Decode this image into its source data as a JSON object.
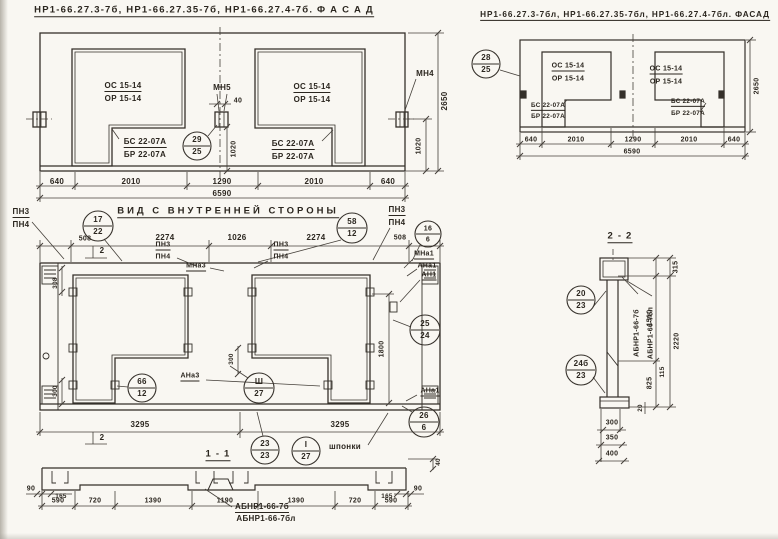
{
  "colors": {
    "paper": "#f9f7f2",
    "ink": "#2b261f"
  },
  "regions": {
    "facade-left": {
      "title": "НР1-66.27.3-7б, НР1-66.27.35-7б, НР1-66.27.4-7б.  Ф А С А Д",
      "labels": [
        {
          "t": "ОС 15-14",
          "x": 123,
          "y": 87,
          "c": "u",
          "n": "window-mark"
        },
        {
          "t": "ОР 15-14",
          "x": 123,
          "y": 99,
          "n": "window-mark"
        },
        {
          "t": "БС 22-07А",
          "x": 145,
          "y": 143,
          "c": "u",
          "n": "block-mark"
        },
        {
          "t": "БР 22-07А",
          "x": 145,
          "y": 155,
          "n": "block-mark"
        },
        {
          "t": "ОС 15-14",
          "x": 312,
          "y": 88,
          "c": "u",
          "n": "window-mark"
        },
        {
          "t": "ОР 15-14",
          "x": 312,
          "y": 100,
          "n": "window-mark"
        },
        {
          "t": "БС 22-07А",
          "x": 293,
          "y": 145,
          "c": "u",
          "n": "block-mark"
        },
        {
          "t": "БР 22-07А",
          "x": 293,
          "y": 157,
          "n": "block-mark"
        },
        {
          "t": "МН5",
          "x": 222,
          "y": 88,
          "n": "anchor-mark"
        },
        {
          "t": "МН4",
          "x": 425,
          "y": 74,
          "n": "anchor-mark"
        },
        {
          "t": "40",
          "x": 238,
          "y": 101,
          "c": "s7",
          "n": "dim"
        },
        {
          "t": "29",
          "x": 197,
          "y": 140,
          "n": "node-number"
        },
        {
          "t": "25",
          "x": 197,
          "y": 152,
          "n": "sheet-number"
        },
        {
          "t": "1020",
          "x": 234,
          "y": 149,
          "c": "r s7",
          "n": "dim"
        },
        {
          "t": "1020",
          "x": 419,
          "y": 146,
          "c": "r s7",
          "n": "dim"
        },
        {
          "t": "2650",
          "x": 445,
          "y": 101,
          "c": "r",
          "n": "dim"
        },
        {
          "t": "640",
          "x": 57,
          "y": 182,
          "n": "dim"
        },
        {
          "t": "2010",
          "x": 131,
          "y": 182,
          "n": "dim"
        },
        {
          "t": "1290",
          "x": 222,
          "y": 182,
          "n": "dim"
        },
        {
          "t": "2010",
          "x": 314,
          "y": 182,
          "n": "dim"
        },
        {
          "t": "640",
          "x": 388,
          "y": 182,
          "n": "dim"
        },
        {
          "t": "6590",
          "x": 222,
          "y": 194,
          "n": "dim-total"
        }
      ]
    },
    "facade-right": {
      "title": "НР1-66.27.3-7бл, НР1-66.27.35-7бл, НР1-66.27.4-7бл. ФАСАД",
      "labels": [
        {
          "t": "28",
          "x": 486,
          "y": 58,
          "n": "node-number"
        },
        {
          "t": "25",
          "x": 486,
          "y": 70,
          "n": "sheet-number"
        },
        {
          "t": "ОС 15-14",
          "x": 568,
          "y": 67,
          "c": "u s7",
          "n": "window-mark"
        },
        {
          "t": "ОР 15-14",
          "x": 568,
          "y": 79,
          "c": "s7",
          "n": "window-mark"
        },
        {
          "t": "БС 22-07А",
          "x": 548,
          "y": 107,
          "c": "u s6",
          "n": "block-mark"
        },
        {
          "t": "БР 22-07А",
          "x": 548,
          "y": 117,
          "c": "s6",
          "n": "block-mark"
        },
        {
          "t": "ОС 15-14",
          "x": 666,
          "y": 70,
          "c": "u s7",
          "n": "window-mark"
        },
        {
          "t": "ОР 15-14",
          "x": 666,
          "y": 82,
          "c": "s7",
          "n": "window-mark"
        },
        {
          "t": "БС 22-07А",
          "x": 688,
          "y": 103,
          "c": "u s6",
          "n": "block-mark"
        },
        {
          "t": "БР 22-07А",
          "x": 688,
          "y": 114,
          "c": "s6",
          "n": "block-mark"
        },
        {
          "t": "640",
          "x": 531,
          "y": 140,
          "c": "s7",
          "n": "dim"
        },
        {
          "t": "2010",
          "x": 576,
          "y": 140,
          "c": "s7",
          "n": "dim"
        },
        {
          "t": "1290",
          "x": 633,
          "y": 140,
          "c": "s7",
          "n": "dim"
        },
        {
          "t": "2010",
          "x": 689,
          "y": 140,
          "c": "s7",
          "n": "dim"
        },
        {
          "t": "640",
          "x": 734,
          "y": 140,
          "c": "s7",
          "n": "dim"
        },
        {
          "t": "6590",
          "x": 632,
          "y": 152,
          "c": "s7",
          "n": "dim-total"
        },
        {
          "t": "2650",
          "x": 757,
          "y": 86,
          "c": "r s7",
          "n": "dim"
        }
      ]
    },
    "inner-view": {
      "title": "ВИД С ВНУТРЕННЕЙ СТОРОНЫ",
      "labels": [
        {
          "t": "ПН3",
          "x": 21,
          "y": 213,
          "c": "u",
          "n": "loop-mark"
        },
        {
          "t": "ПН4",
          "x": 21,
          "y": 225,
          "n": "loop-mark"
        },
        {
          "t": "17",
          "x": 98,
          "y": 220,
          "n": "node-number"
        },
        {
          "t": "22",
          "x": 98,
          "y": 232,
          "n": "sheet-number"
        },
        {
          "t": "58",
          "x": 352,
          "y": 222,
          "n": "node-number"
        },
        {
          "t": "12",
          "x": 352,
          "y": 234,
          "n": "sheet-number"
        },
        {
          "t": "ПН3",
          "x": 397,
          "y": 211,
          "c": "u",
          "n": "loop-mark"
        },
        {
          "t": "ПН4",
          "x": 397,
          "y": 223,
          "n": "loop-mark"
        },
        {
          "t": "16",
          "x": 428,
          "y": 229,
          "c": "s7",
          "n": "node-number"
        },
        {
          "t": "6",
          "x": 428,
          "y": 240,
          "c": "s7",
          "n": "sheet-number"
        },
        {
          "t": "508",
          "x": 85,
          "y": 239,
          "c": "s7",
          "n": "dim"
        },
        {
          "t": "2274",
          "x": 165,
          "y": 238,
          "n": "dim"
        },
        {
          "t": "1026",
          "x": 237,
          "y": 238,
          "n": "dim"
        },
        {
          "t": "2274",
          "x": 316,
          "y": 238,
          "n": "dim"
        },
        {
          "t": "508",
          "x": 400,
          "y": 238,
          "c": "s7",
          "n": "dim"
        },
        {
          "t": "2",
          "x": 102,
          "y": 251,
          "n": "section-mark"
        },
        {
          "t": "2",
          "x": 102,
          "y": 438,
          "n": "section-mark"
        },
        {
          "t": "ПН3",
          "x": 163,
          "y": 246,
          "c": "u s7",
          "n": "loop-mark"
        },
        {
          "t": "ПН4",
          "x": 163,
          "y": 257,
          "c": "s7",
          "n": "loop-mark"
        },
        {
          "t": "ПН3",
          "x": 281,
          "y": 246,
          "c": "u s7",
          "n": "loop-mark"
        },
        {
          "t": "ПН4",
          "x": 281,
          "y": 257,
          "c": "s7",
          "n": "loop-mark"
        },
        {
          "t": "МНа3",
          "x": 196,
          "y": 267,
          "c": "u s7",
          "n": "anchor-mark"
        },
        {
          "t": "308",
          "x": 56,
          "y": 283,
          "c": "r s6",
          "n": "dim"
        },
        {
          "t": "300",
          "x": 56,
          "y": 391,
          "c": "r s6",
          "n": "dim"
        },
        {
          "t": "300",
          "x": 232,
          "y": 359,
          "c": "r s6",
          "n": "dim"
        },
        {
          "t": "66",
          "x": 142,
          "y": 382,
          "n": "node-number"
        },
        {
          "t": "12",
          "x": 142,
          "y": 394,
          "n": "sheet-number"
        },
        {
          "t": "АНа3",
          "x": 190,
          "y": 377,
          "c": "u s7",
          "n": "anchor-mark"
        },
        {
          "t": "Ш",
          "x": 259,
          "y": 382,
          "n": "node-number"
        },
        {
          "t": "27",
          "x": 259,
          "y": 394,
          "n": "sheet-number"
        },
        {
          "t": "МНа1",
          "x": 424,
          "y": 255,
          "c": "u s7",
          "n": "anchor-mark"
        },
        {
          "t": "АНа1",
          "x": 427,
          "y": 266,
          "c": "s7",
          "n": "anchor-mark"
        },
        {
          "t": "АН1",
          "x": 429,
          "y": 276,
          "c": "u s7",
          "n": "anchor-mark"
        },
        {
          "t": "25",
          "x": 425,
          "y": 324,
          "n": "node-number"
        },
        {
          "t": "24",
          "x": 425,
          "y": 336,
          "n": "sheet-number"
        },
        {
          "t": "1800",
          "x": 382,
          "y": 349,
          "c": "r s7",
          "n": "dim"
        },
        {
          "t": "АНа1",
          "x": 430,
          "y": 392,
          "c": "u s7",
          "n": "anchor-mark"
        },
        {
          "t": "26",
          "x": 424,
          "y": 416,
          "n": "node-number"
        },
        {
          "t": "6",
          "x": 424,
          "y": 428,
          "n": "sheet-number"
        },
        {
          "t": "3295",
          "x": 140,
          "y": 425,
          "n": "dim"
        },
        {
          "t": "3295",
          "x": 340,
          "y": 425,
          "n": "dim"
        },
        {
          "t": "23",
          "x": 265,
          "y": 444,
          "n": "node-number"
        },
        {
          "t": "23",
          "x": 265,
          "y": 456,
          "n": "sheet-number"
        },
        {
          "t": "I",
          "x": 306,
          "y": 445,
          "n": "node-number"
        },
        {
          "t": "27",
          "x": 306,
          "y": 457,
          "n": "sheet-number"
        },
        {
          "t": "шпонки",
          "x": 345,
          "y": 447,
          "n": "note"
        }
      ]
    },
    "section-1-1": {
      "title": "1 - 1",
      "labels": [
        {
          "t": "90",
          "x": 31,
          "y": 489,
          "c": "s7",
          "n": "dim"
        },
        {
          "t": "90",
          "x": 418,
          "y": 489,
          "c": "s7",
          "n": "dim"
        },
        {
          "t": "165",
          "x": 61,
          "y": 497,
          "c": "s6",
          "n": "dim"
        },
        {
          "t": "165",
          "x": 387,
          "y": 497,
          "c": "s6",
          "n": "dim"
        },
        {
          "t": "590",
          "x": 58,
          "y": 501,
          "c": "s7",
          "n": "dim"
        },
        {
          "t": "720",
          "x": 95,
          "y": 501,
          "c": "s7",
          "n": "dim"
        },
        {
          "t": "1390",
          "x": 153,
          "y": 501,
          "c": "s7",
          "n": "dim"
        },
        {
          "t": "1190",
          "x": 225,
          "y": 501,
          "c": "s7",
          "n": "dim"
        },
        {
          "t": "1390",
          "x": 296,
          "y": 501,
          "c": "s7",
          "n": "dim"
        },
        {
          "t": "720",
          "x": 355,
          "y": 501,
          "c": "s7",
          "n": "dim"
        },
        {
          "t": "590",
          "x": 391,
          "y": 501,
          "c": "s7",
          "n": "dim"
        },
        {
          "t": "40",
          "x": 439,
          "y": 462,
          "c": "r s6",
          "n": "dim"
        },
        {
          "t": "АБНР1-66-7б",
          "x": 262,
          "y": 508,
          "c": "u",
          "n": "panel-mark"
        },
        {
          "t": "АБНР1-66-7бл",
          "x": 266,
          "y": 519,
          "n": "panel-mark"
        }
      ]
    },
    "section-2-2": {
      "title": "2 - 2",
      "labels": [
        {
          "t": "20",
          "x": 581,
          "y": 294,
          "n": "node-number"
        },
        {
          "t": "23",
          "x": 581,
          "y": 306,
          "n": "sheet-number"
        },
        {
          "t": "24б",
          "x": 581,
          "y": 364,
          "n": "node-number"
        },
        {
          "t": "23",
          "x": 581,
          "y": 376,
          "n": "sheet-number"
        },
        {
          "t": "АБНР1-66-7б",
          "x": 637,
          "y": 333,
          "c": "r s7",
          "n": "panel-mark"
        },
        {
          "t": "АБНР1-66-7бл",
          "x": 651,
          "y": 333,
          "c": "r s7",
          "n": "panel-mark"
        },
        {
          "t": "315",
          "x": 676,
          "y": 267,
          "c": "r s7",
          "n": "dim"
        },
        {
          "t": "1510",
          "x": 650,
          "y": 318,
          "c": "r s7",
          "n": "dim"
        },
        {
          "t": "2220",
          "x": 677,
          "y": 341,
          "c": "r s7",
          "n": "dim"
        },
        {
          "t": "825",
          "x": 650,
          "y": 383,
          "c": "r s7",
          "n": "dim"
        },
        {
          "t": "115",
          "x": 663,
          "y": 372,
          "c": "r s6",
          "n": "dim"
        },
        {
          "t": "20",
          "x": 641,
          "y": 408,
          "c": "r s6",
          "n": "dim"
        },
        {
          "t": "300",
          "x": 612,
          "y": 423,
          "c": "s7",
          "n": "dim"
        },
        {
          "t": "350",
          "x": 612,
          "y": 438,
          "c": "s7",
          "n": "dim"
        },
        {
          "t": "400",
          "x": 612,
          "y": 454,
          "c": "s7",
          "n": "dim"
        }
      ]
    }
  }
}
